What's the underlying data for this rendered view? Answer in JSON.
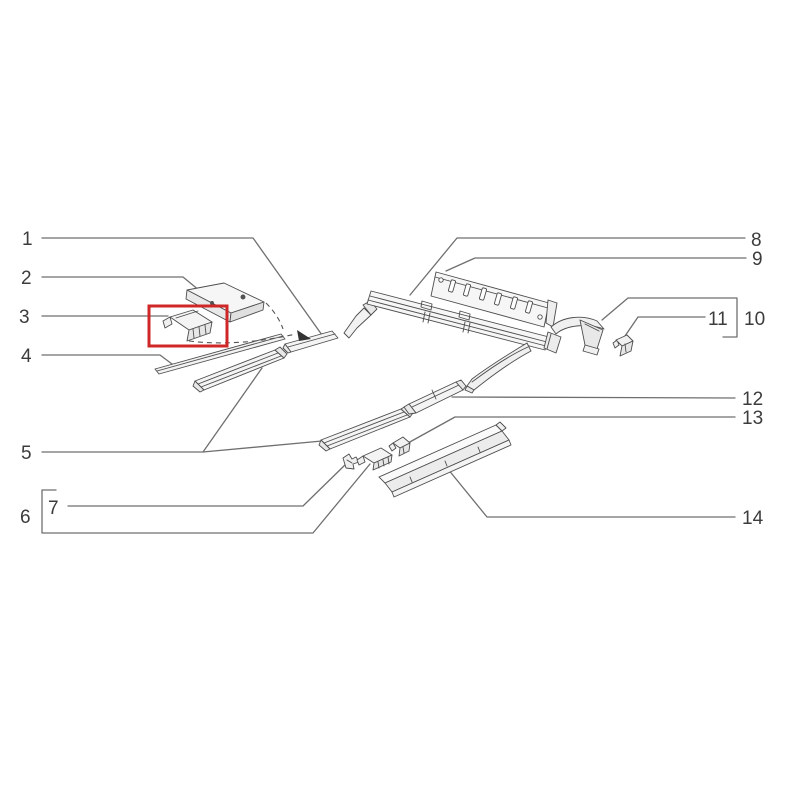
{
  "diagram": {
    "type": "exploded-parts-diagram",
    "background_color": "#ffffff",
    "line_color": "#4a4a4a",
    "leader_color": "#6f6f6f",
    "label_color": "#3c3c3c",
    "highlight_color": "#cf2727",
    "highlighted_callout": "3",
    "grouped_callouts": [
      {
        "group_label": "6",
        "contains": "7"
      },
      {
        "group_label": "10",
        "contains": "11"
      }
    ],
    "callouts": [
      "1",
      "2",
      "3",
      "4",
      "5",
      "6",
      "7",
      "8",
      "9",
      "10",
      "11",
      "12",
      "13",
      "14"
    ]
  }
}
